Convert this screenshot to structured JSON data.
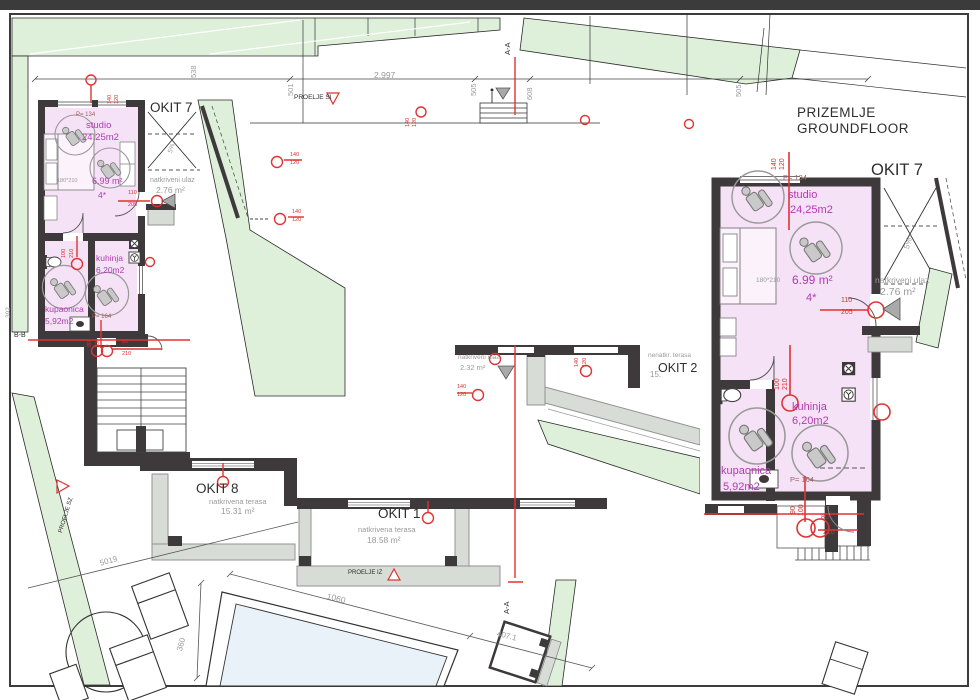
{
  "texts": {
    "title1": "PRIZEMLJE",
    "title2": "GROUNDFLOOR",
    "okit7": "OKIT 7",
    "okit8": "OKIT 8",
    "okit1": "OKIT 1",
    "okit2": "OKIT 2",
    "terasa": "natkrivena terasa",
    "nenatkr": "nenatkr. terasa",
    "area8": "15.31 m²",
    "area1": "18.58 m²",
    "area2p": "15.",
    "ulaz": "natkriveni ulaz",
    "ulaz_area_main": "2.76 m²",
    "ulaz_area_mid": "2.32 m²",
    "studio": "studio",
    "studio_area": "24,25m2",
    "studio_width": "6.99 m²",
    "bed_size": "180*210",
    "stars": "4*",
    "kuhinja": "kuhinja",
    "kuhinja_area": "6,20m2",
    "kupaonica": "kupaonica",
    "kupaonica_area": "5,92m2",
    "p134": "P= 134",
    "p164": "P= 164",
    "slope": "5%",
    "aa": "A-A",
    "bb": "B-B",
    "proelje_si": "PROELJE SI",
    "proelje_iz": "PROELJE IZ",
    "proelje_sz": "PROELJE SZ"
  },
  "dims": {
    "d538": "538",
    "d501": "501",
    "d2997": "2.997",
    "d505": "505",
    "d608": "608",
    "d505b": "505",
    "d5019": "5019",
    "d1060": "1060",
    "d360": "360",
    "d407": "407.1",
    "d392": "392"
  },
  "marks": {
    "m140": "140",
    "m120": "120",
    "m110": "110",
    "m205": "205",
    "m100": "100",
    "m210": "210",
    "m90": "90",
    "m80": "80"
  },
  "colors": {
    "wall": "#3e3a3c",
    "room_pink": "#f6e2f6",
    "magenta": "#b23ab2",
    "green": "#def0da",
    "red": "#e03333",
    "dim_gray": "#9a9a9a",
    "slab_gray": "#d8dcd7",
    "pool_blue": "#e9f1f9"
  }
}
